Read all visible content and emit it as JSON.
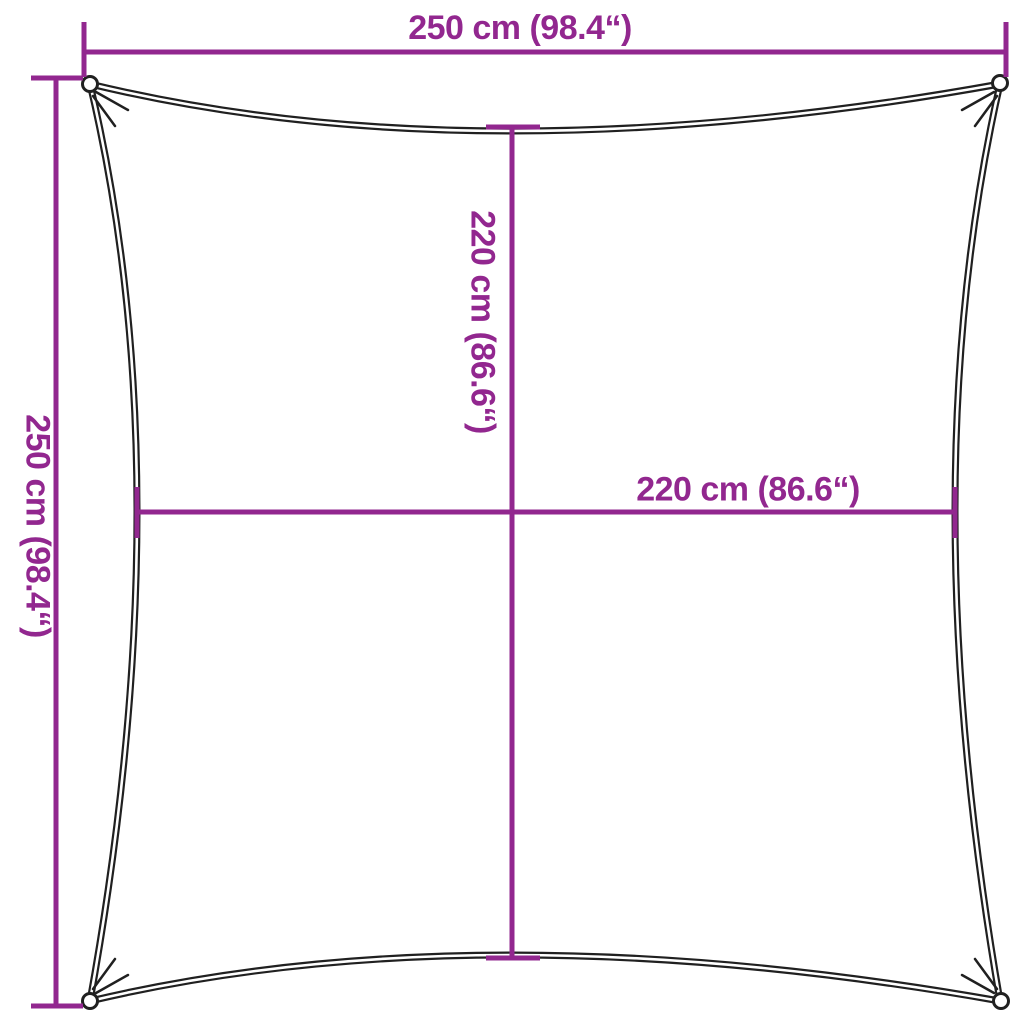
{
  "diagram": {
    "title": "shade-sail-square-dimension-diagram",
    "shape": "square sail with concave edges, corner rings",
    "colors": {
      "dimension": "#92278F",
      "outline": "#202020",
      "background": "#ffffff"
    },
    "dimensions": {
      "overall_width": {
        "label": "250 cm (98.4“)",
        "cm": 250,
        "inches": 98.4
      },
      "overall_height": {
        "label": "250 cm (98.4“)",
        "cm": 250,
        "inches": 98.4
      },
      "center_height": {
        "label": "220 cm (86.6“)",
        "cm": 220,
        "inches": 86.6
      },
      "center_width": {
        "label": "220 cm (86.6“)",
        "cm": 220,
        "inches": 86.6
      }
    }
  }
}
